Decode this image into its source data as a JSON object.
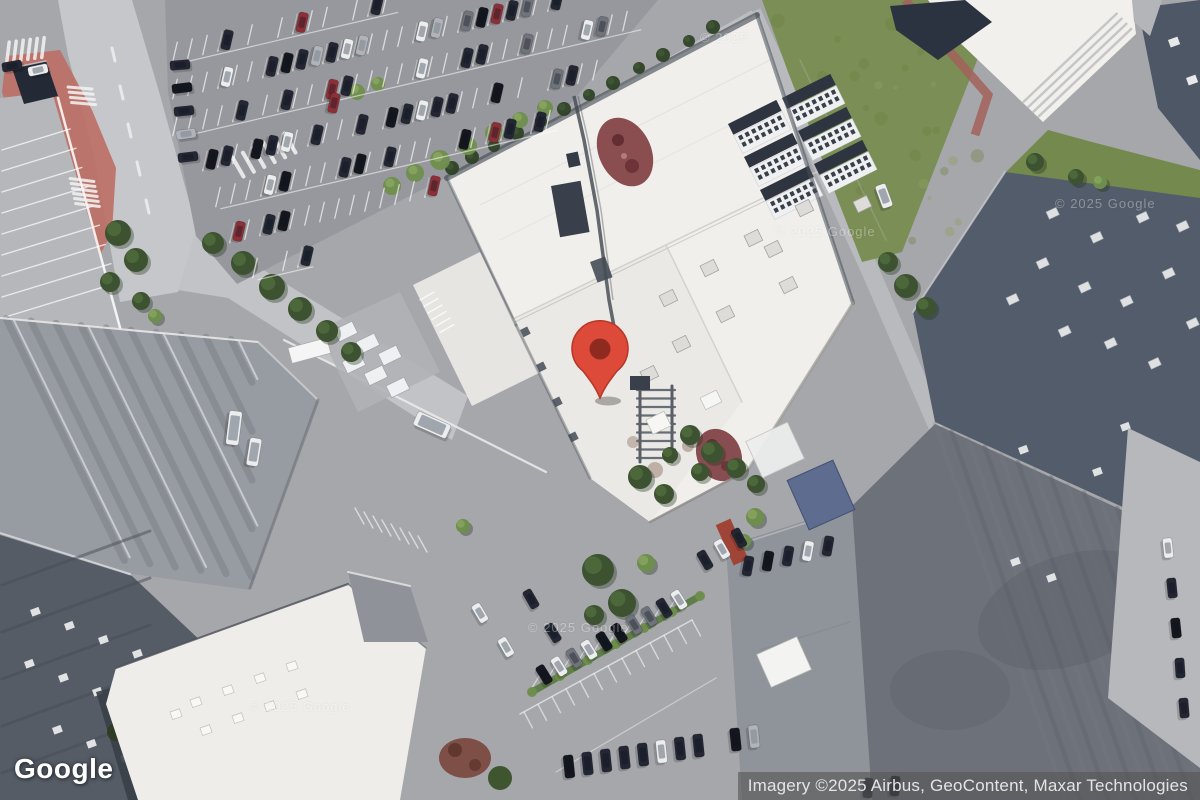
{
  "logo": {
    "text": "Google"
  },
  "attribution": {
    "text": "Imagery ©2025 Airbus, GeoContent, Maxar Technologies"
  },
  "watermarks": [
    {
      "text": "© 2025",
      "x": 700,
      "y": 30
    },
    {
      "text": "© 2025 Google",
      "x": 775,
      "y": 224
    },
    {
      "text": "© 2025 Google",
      "x": 1055,
      "y": 196
    },
    {
      "text": "© 2025 Google",
      "x": 250,
      "y": 699
    },
    {
      "text": "© 2025 Google",
      "x": 528,
      "y": 620
    }
  ],
  "marker": {
    "name": "location-pin",
    "color": "#dd4a3a",
    "outline": "#b93526",
    "dot_color": "#8f2a1f",
    "tip_x": 600,
    "tip_y": 398
  },
  "colors": {
    "grass": "#7b8e55",
    "roof_white": "#f0efeb",
    "roof_dark_slate": "#535c6a",
    "asphalt": "#97989d",
    "attribution_bg": "rgba(85,85,85,0.62)"
  }
}
